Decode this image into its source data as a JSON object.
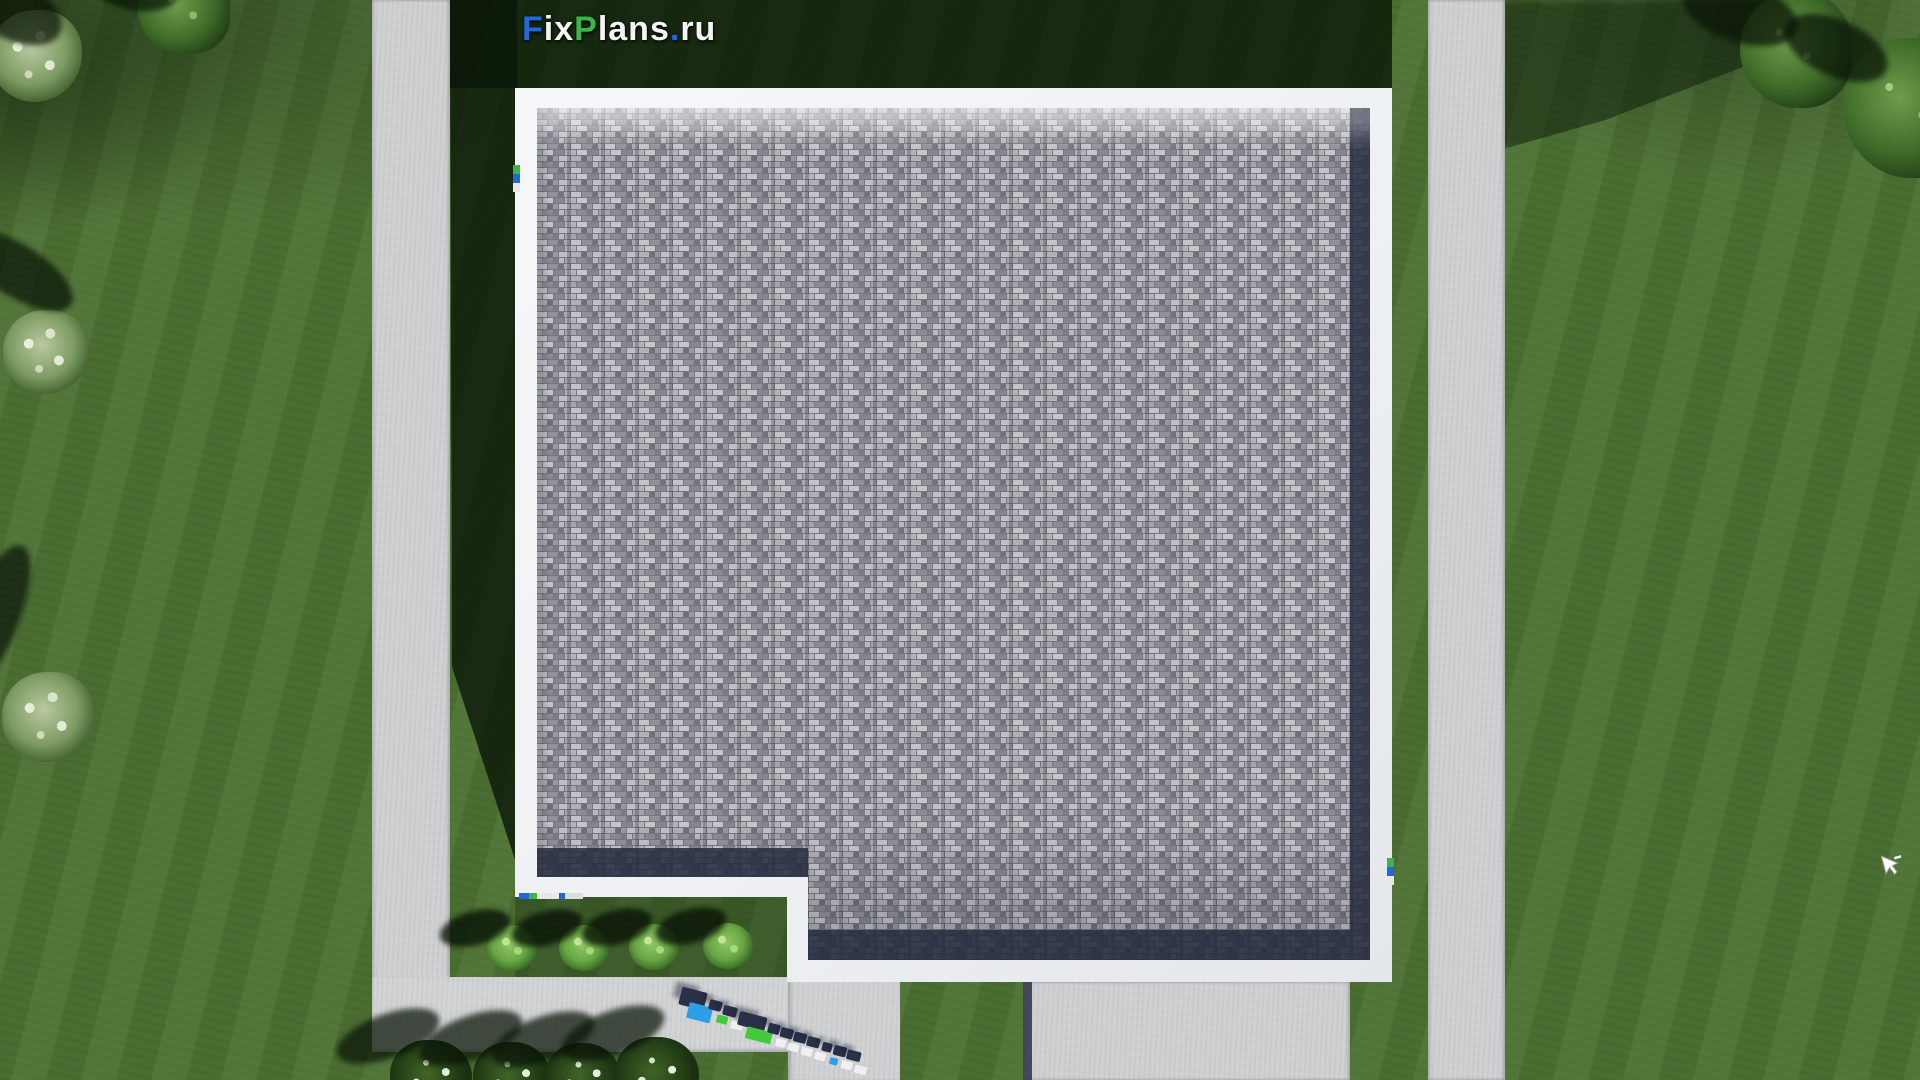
{
  "page": {
    "type": "aerial-3d-house-plan-render",
    "description": "Top-down 3D render of a flat-roof house: gray tile roof with white parapet, lawn, concrete paths and driveway"
  },
  "branding": {
    "full_text": "FixPlans.ru",
    "segments": [
      {
        "text": "F",
        "color": "#2268d8"
      },
      {
        "text": "ix",
        "color": "#f4f4f4"
      },
      {
        "text": "P",
        "color": "#3cb44a"
      },
      {
        "text": "lans",
        "color": "#f4f4f4"
      },
      {
        "text": ".",
        "color": "#2268d8"
      },
      {
        "text": "ru",
        "color": "#f4f4f4"
      }
    ],
    "ground_logo_text": "FixPlans.ru"
  },
  "palette": {
    "grass": "#4d7233",
    "grass_shadow": "#15260e",
    "pavement": "#cfd0d2",
    "parapet_white": "#f3f4f6",
    "roof_tile_gray": "#a3a4ab",
    "roof_edge_navy": "#262c40",
    "bush_light_green": "#8fc766",
    "shrub_white_green": "#dbe5c9",
    "logo_blue": "#2268d8",
    "logo_green": "#3cb44a"
  },
  "scene": {
    "buildings": 1,
    "courtyard_bushes": 4,
    "bottom_row_trees": 4,
    "cursor_visible": true
  }
}
